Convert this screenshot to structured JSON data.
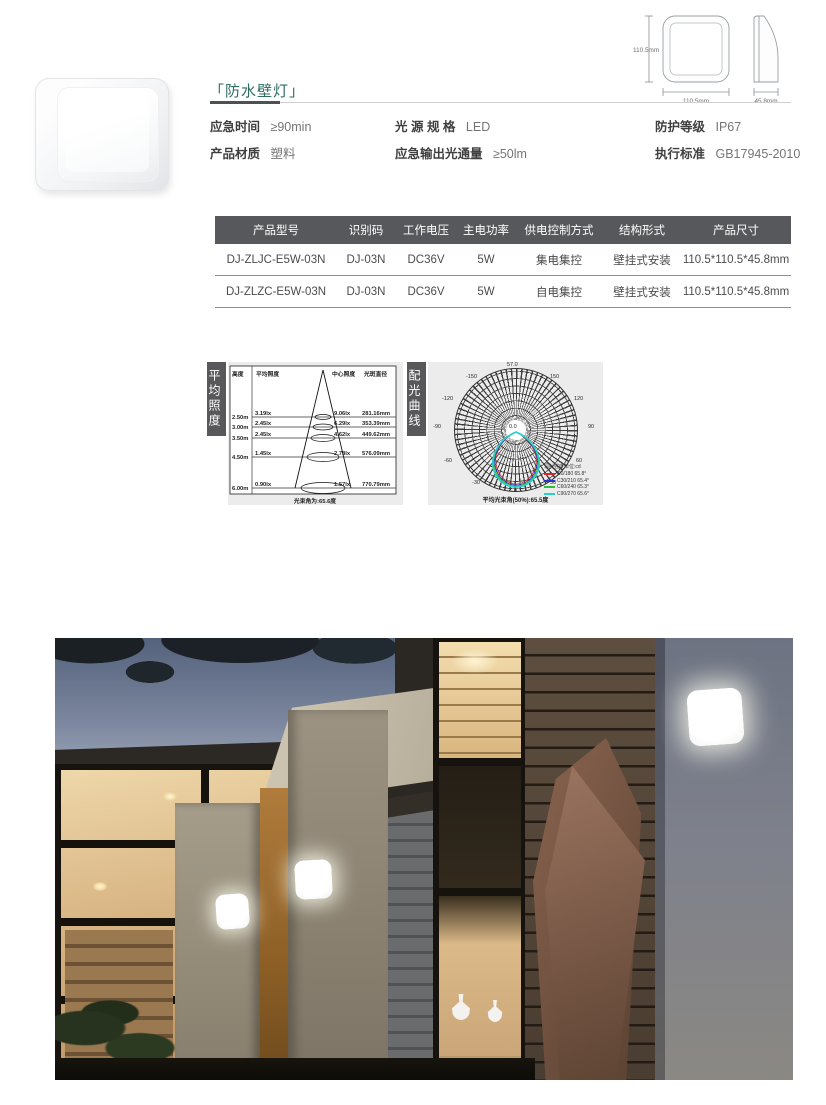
{
  "product": {
    "title": "「防水壁灯」",
    "specs": [
      {
        "label": "应急时间",
        "value": "≥90min"
      },
      {
        "label": "产品材质",
        "value": "塑料"
      },
      {
        "label": "光 源 规 格",
        "value": "LED"
      },
      {
        "label": "应急输出光通量",
        "value": "≥50lm"
      },
      {
        "label": "防护等级",
        "value": "IP67"
      },
      {
        "label": "执行标准",
        "value": "GB17945-2010"
      }
    ]
  },
  "dimensions": {
    "front_height": "110.5mm",
    "front_width": "110.5mm",
    "side_depth": "45.8mm"
  },
  "spec_table": {
    "headers": [
      "产品型号",
      "识别码",
      "工作电压",
      "主电功率",
      "供电控制方式",
      "结构形式",
      "产品尺寸"
    ],
    "rows": [
      [
        "DJ-ZLJC-E5W-03N",
        "DJ-03N",
        "DC36V",
        "5W",
        "集电集控",
        "壁挂式安装",
        "110.5*110.5*45.8mm"
      ],
      [
        "DJ-ZLZC-E5W-03N",
        "DJ-03N",
        "DC36V",
        "5W",
        "自电集控",
        "壁挂式安装",
        "110.5*110.5*45.8mm"
      ]
    ]
  },
  "chart_data": [
    {
      "type": "table",
      "panel_label": "平均照度",
      "columns": [
        "高度",
        "平均照度",
        "中心照度",
        "光斑直径"
      ],
      "rows": [
        {
          "height": "2.50m",
          "avg_lx": "3.19lx",
          "center_lx": "9.06lx",
          "spot_diameter": "281.16mm"
        },
        {
          "height": "3.00m",
          "avg_lx": "2.45lx",
          "center_lx": "6.29lx",
          "spot_diameter": "353.39mm"
        },
        {
          "height": "3.50m",
          "avg_lx": "2.45lx",
          "center_lx": "4.62lx",
          "spot_diameter": "449.62mm"
        },
        {
          "height": "4.50m",
          "avg_lx": "1.45lx",
          "center_lx": "2.78lx",
          "spot_diameter": "576.09mm"
        },
        {
          "height": "6.00m",
          "avg_lx": "0.90lx",
          "center_lx": "1.57lx",
          "spot_diameter": "770.79mm"
        }
      ],
      "beam_angle_note": "光束角为:65.6度"
    },
    {
      "type": "polar",
      "panel_label": "配光曲线",
      "max_value_label": "57.0",
      "center_value_label": "0.0",
      "angle_labels": [
        "-150",
        "150",
        "-120",
        "120",
        "-90",
        "90",
        "-60",
        "60",
        "-30",
        "30",
        "0"
      ],
      "unit_note": "辐射强度单位:cd",
      "series": [
        {
          "name": "C0/180 65.8°",
          "color": "#d82a2a"
        },
        {
          "name": "C30/210 65.4°",
          "color": "#2436c8"
        },
        {
          "name": "C60/240 65.3°",
          "color": "#2fbe3a"
        },
        {
          "name": "C90/270 65.6°",
          "color": "#27cfcd"
        }
      ],
      "avg_beam_angle_note": "平均光束角(50%):65.5度"
    }
  ]
}
